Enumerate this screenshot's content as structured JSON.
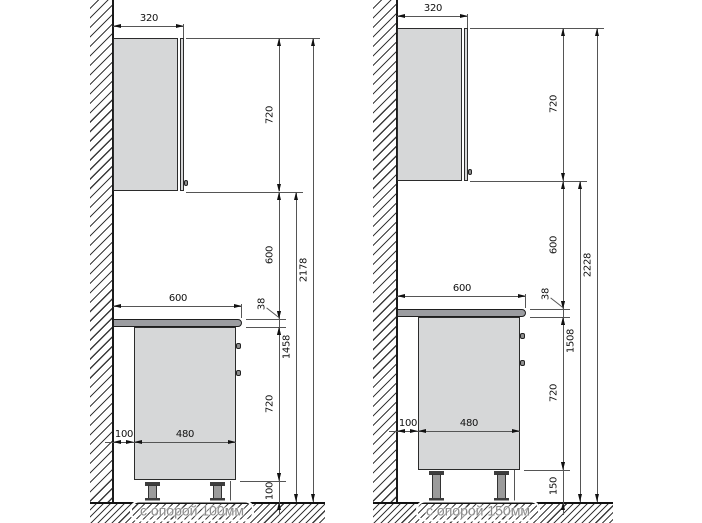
{
  "diagrams": [
    {
      "caption": "с опорой 100мм",
      "dimensions": {
        "wall_cabinet_depth_mm": "320",
        "wall_cabinet_height_mm": "720",
        "cabinet_to_counter_gap_mm": "600",
        "countertop_thickness_mm": "38",
        "countertop_depth_mm": "600",
        "base_cabinet_height_mm": "720",
        "base_cabinet_depth_mm": "480",
        "wall_to_cabinet_gap_mm": "100",
        "leg_height_mm": "100",
        "floor_to_wall_cabinet_mm": "1458",
        "total_height_mm": "2178"
      }
    },
    {
      "caption": "с опорой 150мм",
      "dimensions": {
        "wall_cabinet_depth_mm": "320",
        "wall_cabinet_height_mm": "720",
        "cabinet_to_counter_gap_mm": "600",
        "countertop_thickness_mm": "38",
        "countertop_depth_mm": "600",
        "base_cabinet_height_mm": "720",
        "base_cabinet_depth_mm": "480",
        "wall_to_cabinet_gap_mm": "100",
        "leg_height_mm": "150",
        "floor_to_wall_cabinet_mm": "1508",
        "total_height_mm": "2228"
      }
    }
  ],
  "colors": {
    "cabinet_fill": "#d6d7d8",
    "countertop_fill": "#9b9ca0",
    "line": "#555555",
    "dim_text": "#111111",
    "caption_text": "#8a8a8a"
  }
}
